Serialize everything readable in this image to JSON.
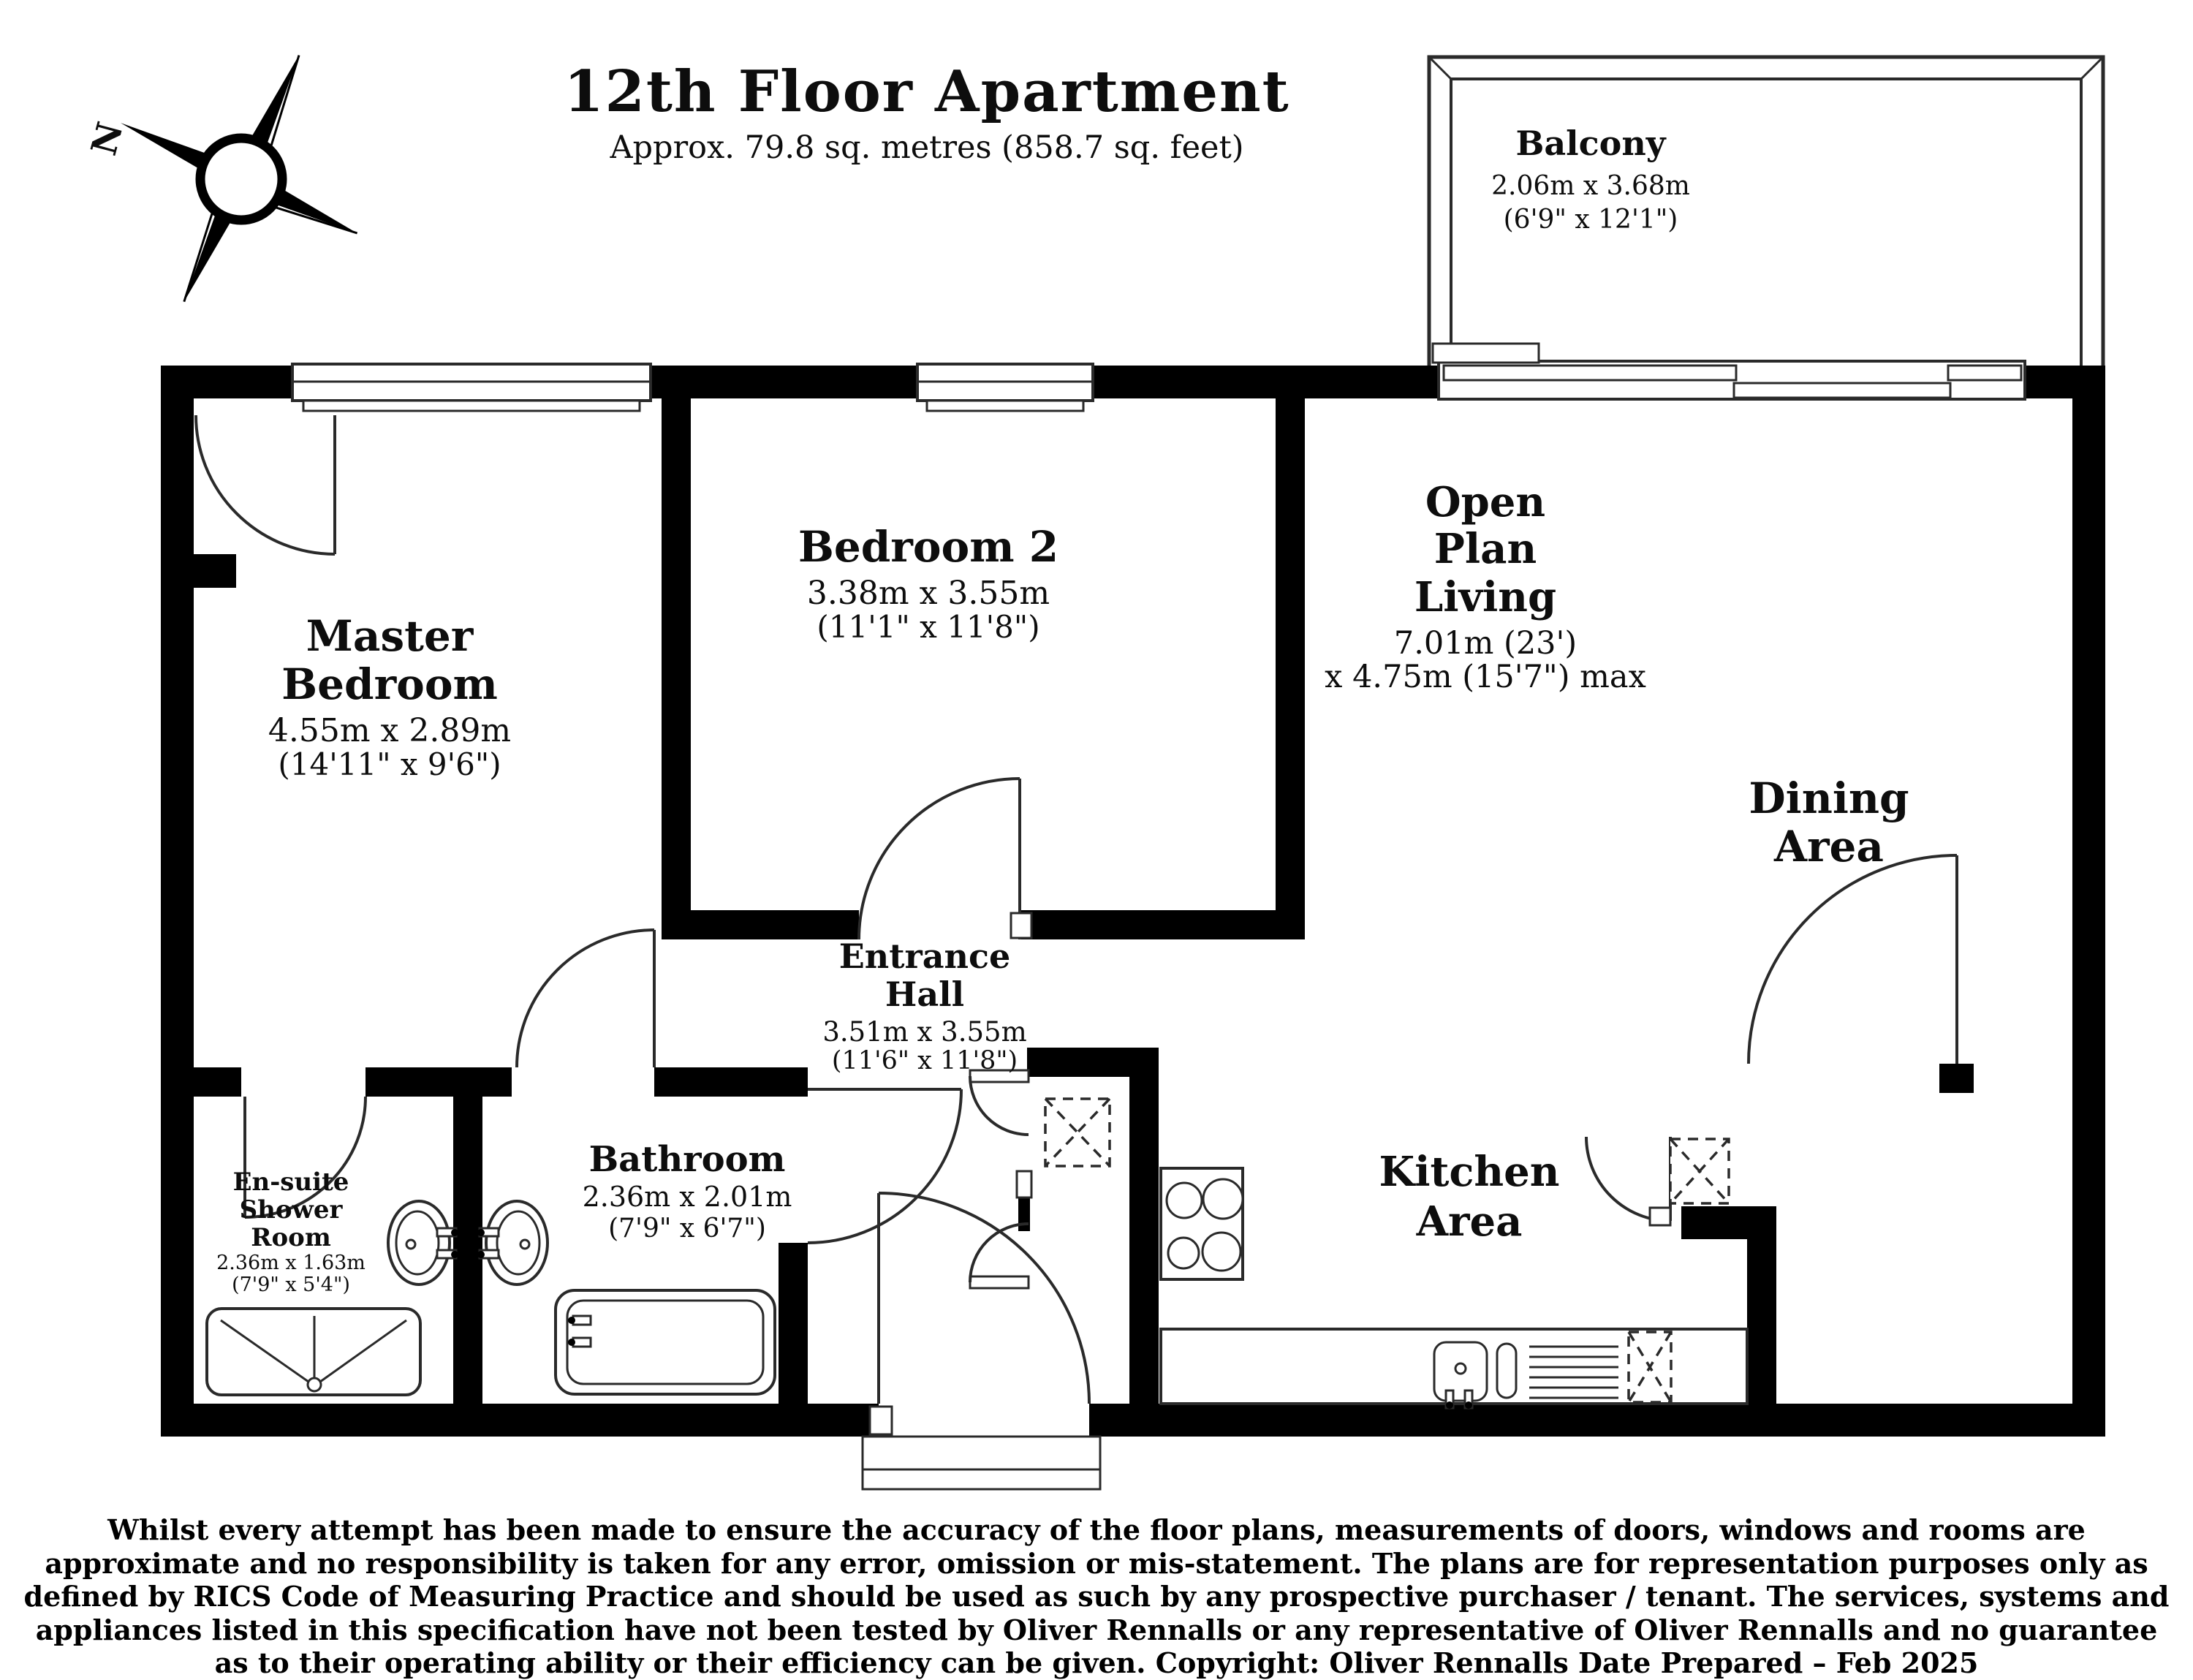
{
  "title": {
    "heading": "12th  Floor Apartment",
    "subheading": "Approx. 79.8 sq. metres (858.7 sq. feet)"
  },
  "compass": {
    "north_label": "N"
  },
  "rooms": {
    "balcony": {
      "name": "Balcony",
      "dims_metric": "2.06m x 3.68m",
      "dims_imperial": "(6'9\" x 12'1\")"
    },
    "master_bedroom": {
      "name_line1": "Master",
      "name_line2": "Bedroom",
      "dims_metric": "4.55m x 2.89m",
      "dims_imperial": "(14'11\" x 9'6\")"
    },
    "bedroom2": {
      "name": "Bedroom 2",
      "dims_metric": "3.38m x 3.55m",
      "dims_imperial": "(11'1\" x 11'8\")"
    },
    "open_plan_living": {
      "name_line1": "Open",
      "name_line2": "Plan",
      "name_line3": "Living",
      "dims_line1": "7.01m (23')",
      "dims_line2": "x 4.75m (15'7\") max"
    },
    "dining_area": {
      "name_line1": "Dining",
      "name_line2": "Area"
    },
    "entrance_hall": {
      "name_line1": "Entrance",
      "name_line2": "Hall",
      "dims_metric": "3.51m x 3.55m",
      "dims_imperial": "(11'6\" x 11'8\")"
    },
    "kitchen_area": {
      "name_line1": "Kitchen",
      "name_line2": "Area"
    },
    "bathroom": {
      "name": "Bathroom",
      "dims_metric": "2.36m x 2.01m",
      "dims_imperial": "(7'9\" x 6'7\")"
    },
    "ensuite": {
      "name_line1": "En-suite",
      "name_line2": "Shower",
      "name_line3": "Room",
      "dims_metric": "2.36m x 1.63m",
      "dims_imperial": "(7'9\" x 5'4\")"
    }
  },
  "footer": {
    "disclaimer": "Whilst every attempt has been made to ensure the accuracy of the floor plans, measurements of doors, windows and rooms are approximate and no responsibility is taken for any error, omission or mis-statement. The plans are for representation purposes only as defined by RICS Code of Measuring Practice and should be used as such by any prospective purchaser / tenant. The services, systems and appliances listed in this specification have not been tested by Oliver Rennalls or any representative of Oliver Rennalls and no guarantee as to their operating ability or their efficiency can be given. Copyright: Oliver Rennalls Date Prepared – Feb 2025"
  },
  "colors": {
    "wall": "#000000",
    "line": "#2a2a2a",
    "background": "#ffffff"
  }
}
